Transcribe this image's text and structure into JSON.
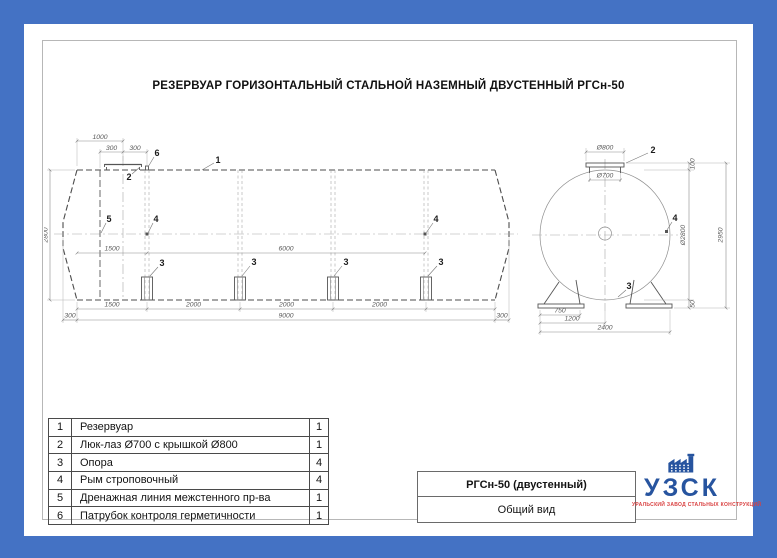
{
  "title": "РЕЗЕРВУАР ГОРИЗОНТАЛЬНЫЙ СТАЛЬНОЙ НАЗЕМНЫЙ ДВУСТЕННЫЙ РГСн-50",
  "side_view": {
    "callouts": {
      "c1": "1",
      "c2": "2",
      "c3": "3",
      "c4": "4",
      "c5": "5",
      "c6": "6"
    },
    "dims": {
      "top_overall": "1000",
      "top_left": "300",
      "top_right": "300",
      "height": "2800",
      "inner_left": "1500",
      "inner_span": "6000",
      "chain_1": "1500",
      "chain_2": "2000",
      "chain_3": "2000",
      "chain_4": "2000",
      "base_left": "300",
      "base_total": "9000",
      "base_right": "300"
    }
  },
  "end_view": {
    "callouts": {
      "c2": "2",
      "c3": "3",
      "c4": "4"
    },
    "dims": {
      "cover": "Ø800",
      "manhole": "Ø700",
      "top_offset": "100",
      "diameter": "Ø2800",
      "overall_height": "2950",
      "base_offset": "50",
      "support_width": "750",
      "support_half": "1200",
      "support_span": "2400"
    }
  },
  "parts_table": {
    "rows": [
      {
        "num": "1",
        "name": "Резервуар",
        "qty": "1"
      },
      {
        "num": "2",
        "name": "Люк-лаз Ø700 с крышкой Ø800",
        "qty": "1"
      },
      {
        "num": "3",
        "name": "Опора",
        "qty": "4"
      },
      {
        "num": "4",
        "name": "Рым строповочный",
        "qty": "4"
      },
      {
        "num": "5",
        "name": "Дренажная линия межстенного пр-ва",
        "qty": "1"
      },
      {
        "num": "6",
        "name": "Патрубок контроля герметичности",
        "qty": "1"
      }
    ]
  },
  "title_block": {
    "model": "РГСн-50 (двустенный)",
    "view_label": "Общий вид"
  },
  "logo": {
    "abbr": "УЗСК",
    "subtitle": "УРАЛЬСКИЙ ЗАВОД СТАЛЬНЫХ КОНСТРУКЦИЙ"
  },
  "colors": {
    "frame_blue": "#4472c4",
    "logo_blue": "#27549f",
    "logo_red": "#d94040"
  }
}
